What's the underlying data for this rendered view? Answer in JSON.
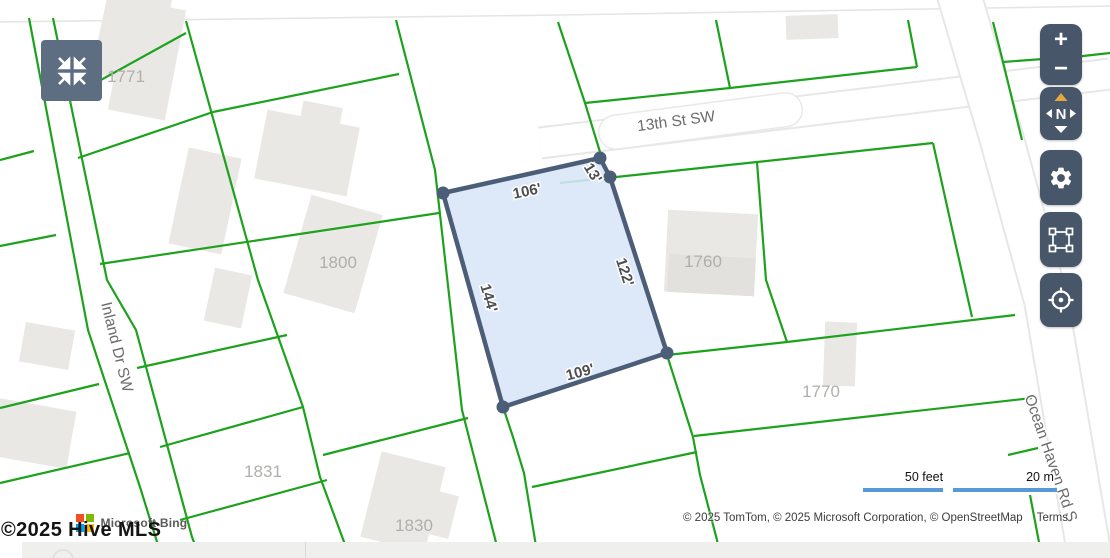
{
  "map": {
    "streets": {
      "s13th": "13th St SW",
      "inland": "Inland Dr SW",
      "ocean": "Ocean Haven Rd S"
    },
    "parcels": {
      "p1771": "1771",
      "p1800": "1800",
      "p1760": "1760",
      "p1770": "1770",
      "p1831": "1831",
      "p1830": "1830"
    },
    "highlight_measurements": {
      "top": "106'",
      "top_right": "13'",
      "right": "122'",
      "bottom": "109'",
      "left": "144'"
    },
    "scale": {
      "feet": "50 feet",
      "meters": "20 m"
    }
  },
  "controls": {
    "zoom_in": "+",
    "zoom_out": "−",
    "compass_n": "N"
  },
  "attribution": {
    "copyright": "© 2025 TomTom, © 2025 Microsoft Corporation, © OpenStreetMap",
    "terms": "Terms",
    "bing_label": "Microsoft Bing",
    "hive": "©2025 Hive MLS"
  },
  "colors": {
    "parcel_line": "#1da21d",
    "highlight_fill": "#d8e6f8",
    "highlight_stroke": "#4c5e77",
    "control_bg": "#475669",
    "collapse_bg": "#5d6e82",
    "scale_bar": "#5898d4",
    "ms_red": "#f25022",
    "ms_green": "#7fba00",
    "ms_blue": "#00a4ef",
    "ms_yellow": "#ffb900"
  }
}
